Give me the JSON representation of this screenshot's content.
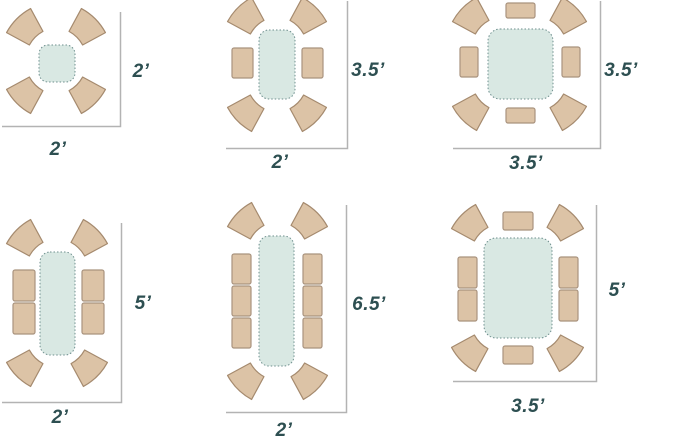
{
  "title": "Table seating capacity floor-plan diagrams",
  "colors": {
    "chair_fill": "#dcc3a6",
    "chair_border": "#a58a6e",
    "table_fill": "#d9e8e3",
    "table_border": "#6e8f8e",
    "dimension_line": "#b3b3b3",
    "label_text": "#2d4f51",
    "background": "#ffffff"
  },
  "diagrams": [
    {
      "seats": 4,
      "curved_chairs": 4,
      "rect_chairs": 0,
      "width_label": "2’",
      "depth_label": "2’"
    },
    {
      "seats": 6,
      "curved_chairs": 4,
      "rect_chairs": 2,
      "width_label": "2’",
      "depth_label": "3.5’"
    },
    {
      "seats": 8,
      "curved_chairs": 4,
      "rect_chairs": 4,
      "width_label": "3.5’",
      "depth_label": "3.5’"
    },
    {
      "seats": 8,
      "curved_chairs": 4,
      "rect_chairs": 4,
      "width_label": "2’",
      "depth_label": "5’"
    },
    {
      "seats": 10,
      "curved_chairs": 4,
      "rect_chairs": 6,
      "width_label": "2’",
      "depth_label": "6.5’"
    },
    {
      "seats": 10,
      "curved_chairs": 4,
      "rect_chairs": 6,
      "width_label": "3.5’",
      "depth_label": "5’"
    }
  ]
}
